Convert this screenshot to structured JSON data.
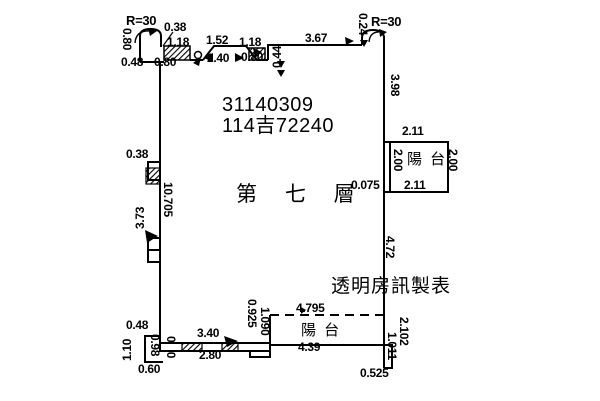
{
  "plan": {
    "parcel_number_line1": "31140309",
    "parcel_number_line2": "114吉72240",
    "floor_label": "第 七 層",
    "watermark": "透明房訊製表",
    "balcony_right_label": "陽 台",
    "balcony_bottom_label": "陽 台",
    "corner_left_radius": "R=30",
    "corner_right_radius": "R=30"
  },
  "dims": {
    "d038_top": "0.38",
    "d118_a": "1.18",
    "d152": "1.52",
    "d118_b": "1.18",
    "d367": "3.67",
    "d024": "0.24",
    "d080_v": "0.80",
    "d048_top": "0.48",
    "d080_a": "0.80",
    "d240": "2.40",
    "d080_b": "0.80",
    "d044": "0.44",
    "d398": "3.98",
    "d211_top": "2.11",
    "d200_l": "2.00",
    "d200_r": "2.00",
    "d211_bot": "2.11",
    "d0075": "0.075",
    "d038_left": "0.38",
    "d373": "3.73",
    "d10705": "10.705",
    "d472": "4.72",
    "d048_bot": "0.48",
    "d110": "1.10",
    "d098": "0.98",
    "d060": "0.60",
    "d030": "0.30",
    "d340": "3.40",
    "d280": "2.80",
    "d0925": "0.925",
    "d1090": "1.090",
    "d4795": "4.795",
    "d439": "4.39",
    "d2102": "2.102",
    "d1011": "1.011",
    "d0525": "0.525"
  }
}
